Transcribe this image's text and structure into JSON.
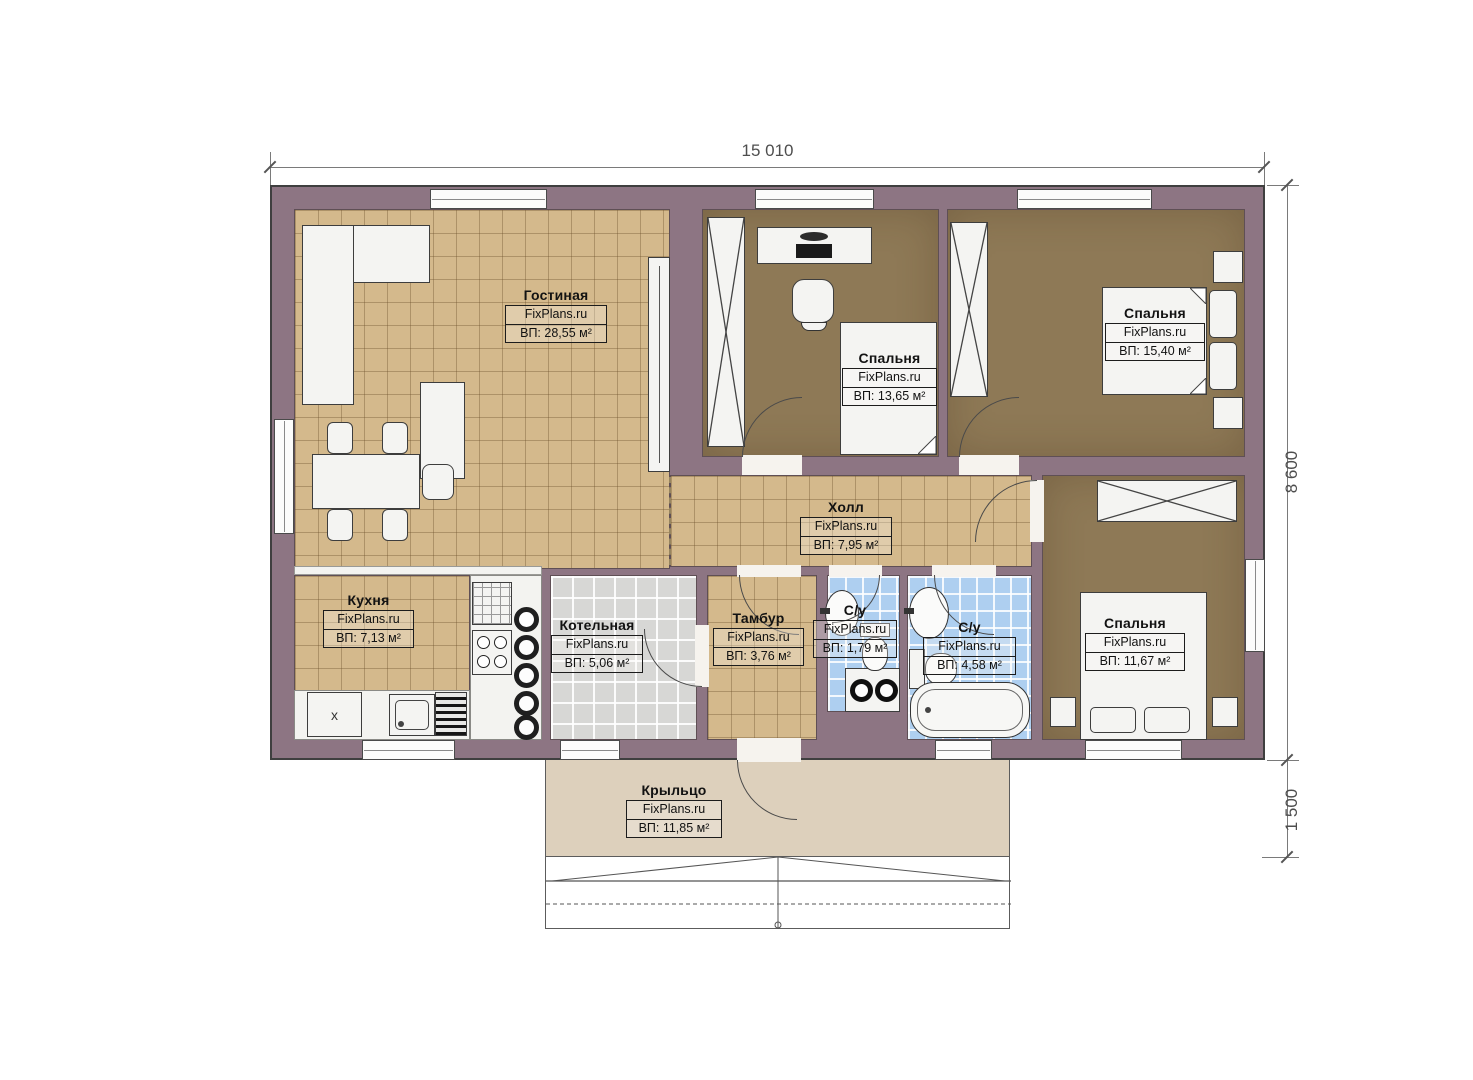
{
  "dimensions": {
    "overall_width": "15 010",
    "overall_depth": "8 600",
    "porch_depth": "1 500"
  },
  "watermark": "FixPlans.ru",
  "rooms": [
    {
      "name": "Гостиная",
      "area": "ВП: 28,55 м²"
    },
    {
      "name": "Спальня",
      "area": "ВП: 13,65 м²"
    },
    {
      "name": "Спальня",
      "area": "ВП: 15,40 м²"
    },
    {
      "name": "Холл",
      "area": "ВП: 7,95 м²"
    },
    {
      "name": "Кухня",
      "area": "ВП: 7,13 м²"
    },
    {
      "name": "Котельная",
      "area": "ВП: 5,06 м²"
    },
    {
      "name": "Тамбур",
      "area": "ВП: 3,76 м²"
    },
    {
      "name": "С/у",
      "area": "ВП: 1,79 м²"
    },
    {
      "name": "С/у",
      "area": "ВП: 4,58 м²"
    },
    {
      "name": "Спальня",
      "area": "ВП: 11,67 м²"
    },
    {
      "name": "Крыльцо",
      "area": "ВП: 11,85 м²"
    }
  ],
  "markers": {
    "kitchen_fridge": "x"
  },
  "colors": {
    "wall": "#8d7583",
    "tile_beige": "#d4b98c",
    "floor_brown": "#8e7956",
    "tile_blue": "#aecff0",
    "tile_gray": "#d7d7d5",
    "porch": "#ddd0bc"
  }
}
